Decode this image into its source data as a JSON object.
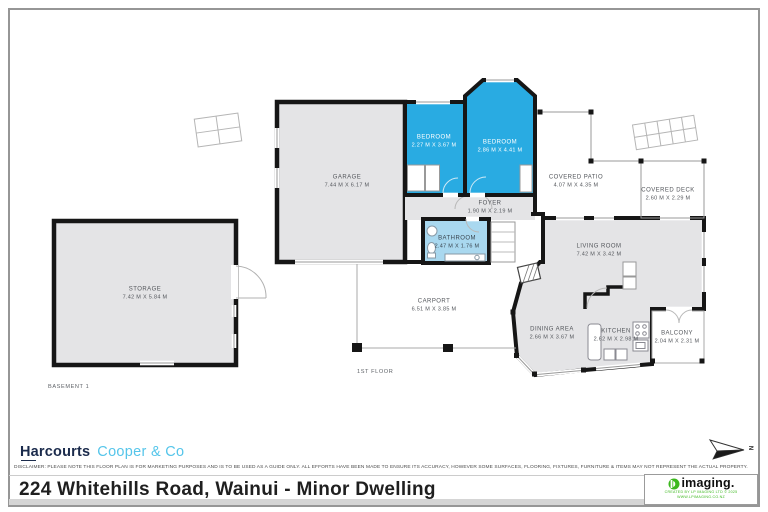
{
  "rooms": [
    {
      "id": "storage",
      "name": "STORAGE",
      "dims": "7.42 M X 5.84 M"
    },
    {
      "id": "garage",
      "name": "GARAGE",
      "dims": "7.44 M X 6.17 M"
    },
    {
      "id": "bedroom-1",
      "name": "BEDROOM",
      "dims": "2.27 M X 3.67 M"
    },
    {
      "id": "bedroom-2",
      "name": "BEDROOM",
      "dims": "2.86 M X 4.41 M"
    },
    {
      "id": "foyer",
      "name": "FOYER",
      "dims": "1.90 M X 2.19 M"
    },
    {
      "id": "bathroom",
      "name": "BATHROOM",
      "dims": "2.47 M X 1.76 M"
    },
    {
      "id": "covered-patio",
      "name": "COVERED PATIO",
      "dims": "4.07 M X 4.35 M"
    },
    {
      "id": "covered-deck",
      "name": "COVERED DECK",
      "dims": "2.60 M X 2.29 M"
    },
    {
      "id": "living-room",
      "name": "LIVING ROOM",
      "dims": "7.42 M X 3.42 M"
    },
    {
      "id": "carport",
      "name": "CARPORT",
      "dims": "6.51 M X 3.85 M"
    },
    {
      "id": "dining-area",
      "name": "DINING AREA",
      "dims": "2.66 M X 3.67 M"
    },
    {
      "id": "kitchen",
      "name": "KITCHEN",
      "dims": "2.62 M X 2.98 M"
    },
    {
      "id": "balcony",
      "name": "BALCONY",
      "dims": "2.04 M X 2.31 M"
    }
  ],
  "floors": {
    "basement": "BASEMENT 1",
    "first": "1ST FLOOR"
  },
  "compass": {
    "label": "N"
  },
  "footer": {
    "brand": {
      "primary": "Harcourts",
      "secondary": "Cooper & Co"
    },
    "disclaimer": "DISCLAIMER: PLEASE NOTE THIS FLOOR PLAN IS FOR MARKETING PURPOSES AND IS TO BE USED AS A GUIDE ONLY. ALL EFFORTS HAVE BEEN MADE TO ENSURE ITS ACCURACY, HOWEVER SOME SURFACES, FLOORING, FIXTURES, FURNITURE & ITEMS MAY NOT REPRESENT THE ACTUAL PROPERTY.",
    "address": "224 Whitehills Road, Wainui - Minor Dwelling",
    "vendor": {
      "logo_text": "imaging.",
      "credit_line1": "CREATED BY LP IMAGING LTD © 2025",
      "credit_line2": "WWW.LPIMAGING.CO.NZ"
    }
  },
  "colors": {
    "bedroom_fill": "#29ABE2",
    "bathroom_fill": "#A9D8EF",
    "room_fill": "#E4E4E6",
    "wall": "#161616",
    "brand_navy": "#1B2B4C",
    "brand_blue": "#55C5EA",
    "vendor_green": "#3CB81E"
  }
}
